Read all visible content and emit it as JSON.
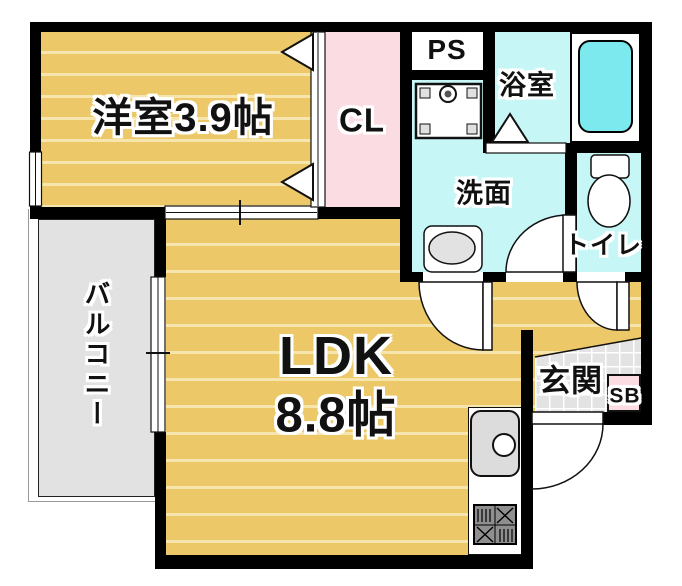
{
  "floorplan": {
    "rooms": {
      "western_room": {
        "label": "洋室3.9帖"
      },
      "closet": {
        "label": "CL"
      },
      "pipe_space": {
        "label": "PS"
      },
      "bathroom": {
        "label": "浴室"
      },
      "washroom": {
        "label": "洗面"
      },
      "toilet": {
        "label": "トイレ"
      },
      "balcony": {
        "label": "バルコニー"
      },
      "ldk": {
        "label_line1": "LDK",
        "label_line2": "8.8帖"
      },
      "entrance": {
        "label": "玄関"
      },
      "shoe_box": {
        "label": "SB"
      }
    },
    "colors": {
      "floor_orange": "#ecc868",
      "floor_stripe": "#f6e6ae",
      "closet_pink": "#fbdce2",
      "wet_area_cyan": "#c7f6f7",
      "bathtub_cyan": "#7ce9ef",
      "balcony_gray": "#e2e2e2",
      "tile_gray": "#e3e3e3",
      "wall_black": "#000000"
    }
  }
}
